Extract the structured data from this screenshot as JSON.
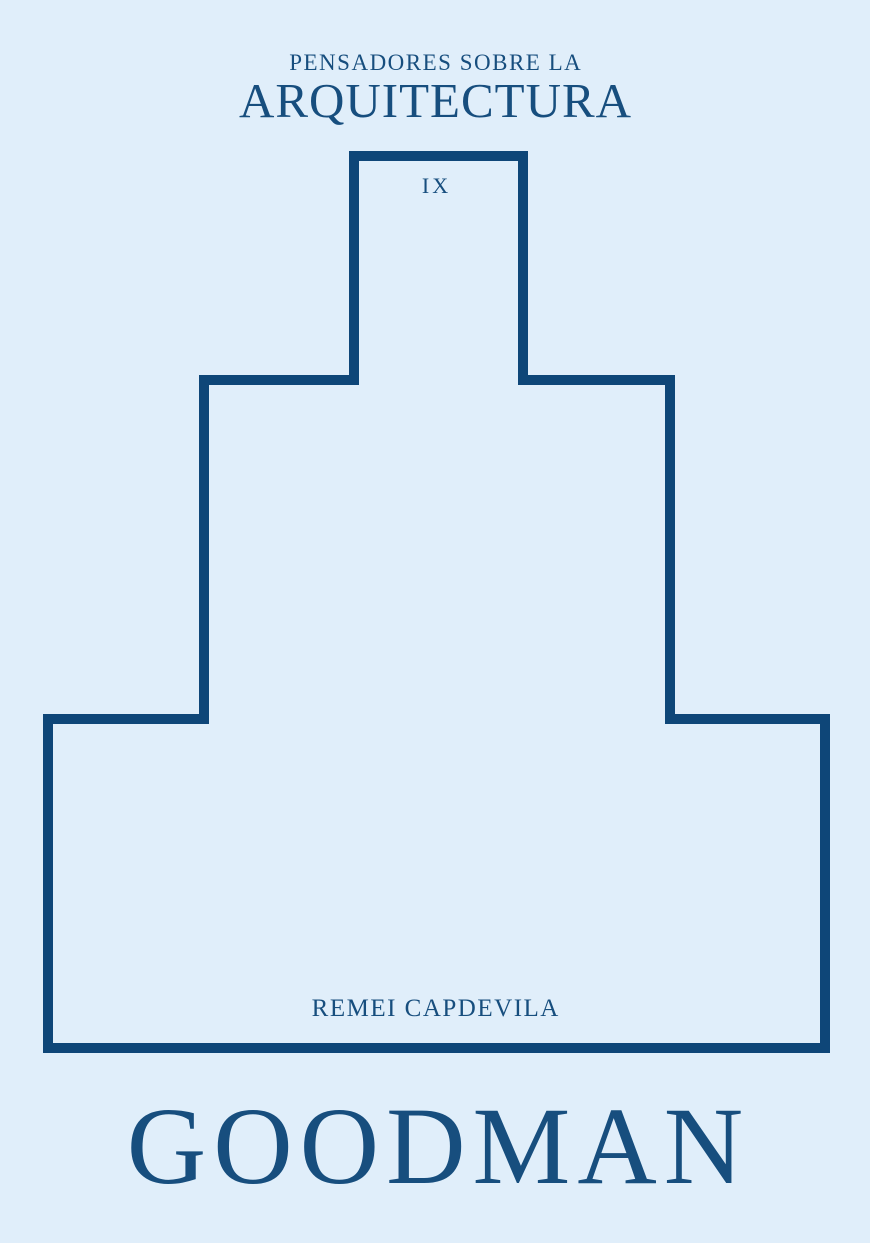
{
  "cover": {
    "series_label": "PENSADORES SOBRE LA",
    "series_title": "ARQUITECTURA",
    "volume_number": "IX",
    "author_name": "REMEI CAPDEVILA",
    "book_title": "GOODMAN",
    "outline_shape": "stepped-building-silhouette",
    "colors": {
      "background": "#e0eefa",
      "outline": "#0e4678",
      "text": "#174e7e"
    }
  }
}
